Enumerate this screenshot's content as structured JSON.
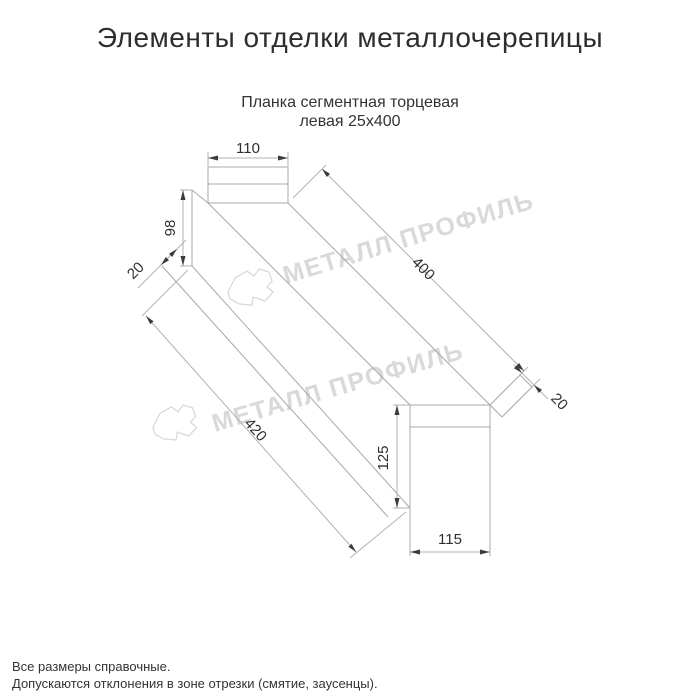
{
  "page": {
    "title": "Элементы отделки металлочерепицы",
    "subtitle_line1": "Планка сегментная торцевая",
    "subtitle_line2": "левая 25х400"
  },
  "drawing": {
    "type": "technical-drawing",
    "product": "Планка сегментная торцевая левая 25х400",
    "dimensions": {
      "top_flange_width": "110",
      "left_end_height": "98",
      "left_hem": "20",
      "top_edge_length": "400",
      "bottom_edge_length": "420",
      "right_end_height": "125",
      "right_end_width": "115",
      "right_hem": "20"
    }
  },
  "watermark": {
    "text": "МЕТАЛЛ ПРОФИЛЬ",
    "logo": "cloud-logo",
    "color": "#d9d9d9"
  },
  "notes": [
    "Все размеры справочные.",
    "Допускаются отклонения в зоне отрезки (смятие, заусенцы)."
  ],
  "colors": {
    "background": "#ffffff",
    "line": "#a8a8a8",
    "text": "#2f2f2f",
    "watermark": "#d9d9d9"
  }
}
